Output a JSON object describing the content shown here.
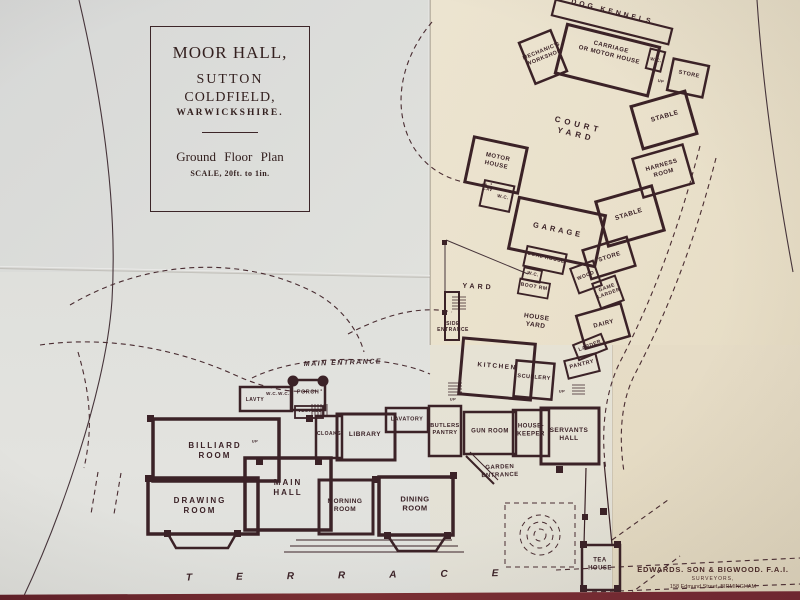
{
  "colors": {
    "ink": "#3b2227",
    "paper_cool": "#dddedb",
    "paper_warm": "#e9e0ca",
    "paper_warm_dark": "#e3d9c1",
    "table_red": "#6e2731"
  },
  "title_block": {
    "title": "MOOR HALL,",
    "line2": "SUTTON",
    "line3": "COLDFIELD,",
    "line4": "WARWICKSHIRE.",
    "plan_title": "Ground Floor Plan",
    "scale": "SCALE, 20ft. to 1in."
  },
  "terrace": {
    "label": "TERRACE"
  },
  "surveyor": {
    "name": "EDWARDS. SON & BIGWOOD. F.A.I.",
    "role": "SURVEYORS,",
    "address": "158 Edmund Street, BIRMINGHAM"
  },
  "rooms": [
    {
      "id": "dog-kennels",
      "label": "DOG KENNELS",
      "x": 612,
      "y": 13,
      "rot": 14,
      "fs": 7,
      "ls": 3
    },
    {
      "id": "mechanics-workshop",
      "label": "MECHANIC'S\nWORKSHOP",
      "x": 543,
      "y": 55,
      "rot": -22,
      "fs": 5.5
    },
    {
      "id": "carriage-house",
      "label": "CARRIAGE\nOR MOTOR HOUSE",
      "x": 610,
      "y": 52,
      "rot": 14,
      "fs": 6
    },
    {
      "id": "wc-top",
      "label": "W.C.",
      "x": 656,
      "y": 60,
      "rot": 12,
      "fs": 4.5
    },
    {
      "id": "store-top",
      "label": "STORE",
      "x": 689,
      "y": 75,
      "rot": 12,
      "fs": 5.5
    },
    {
      "id": "up-top",
      "label": "UP",
      "x": 661,
      "y": 81,
      "rot": 12,
      "fs": 4
    },
    {
      "id": "stable-1",
      "label": "STABLE",
      "x": 665,
      "y": 117,
      "rot": -16,
      "fs": 6.5
    },
    {
      "id": "harness-room",
      "label": "HARNESS\nROOM",
      "x": 663,
      "y": 170,
      "rot": -16,
      "fs": 6
    },
    {
      "id": "stable-2",
      "label": "STABLE",
      "x": 629,
      "y": 215,
      "rot": -18,
      "fs": 6.5
    },
    {
      "id": "store-2",
      "label": "STORE",
      "x": 610,
      "y": 258,
      "rot": -18,
      "fs": 6
    },
    {
      "id": "wood",
      "label": "WOOD",
      "x": 586,
      "y": 276,
      "rot": -22,
      "fs": 5
    },
    {
      "id": "game-larder",
      "label": "GAME\nLARDER",
      "x": 608,
      "y": 291,
      "rot": -20,
      "fs": 5
    },
    {
      "id": "dairy",
      "label": "DAIRY",
      "x": 604,
      "y": 325,
      "rot": -14,
      "fs": 6
    },
    {
      "id": "larder",
      "label": "LARDER",
      "x": 590,
      "y": 346,
      "rot": -22,
      "fs": 5
    },
    {
      "id": "pantry",
      "label": "PANTRY",
      "x": 582,
      "y": 365,
      "rot": -14,
      "fs": 5.5
    },
    {
      "id": "court-yard",
      "label": "COURT\nYARD",
      "x": 577,
      "y": 130,
      "rot": 14,
      "fs": 8,
      "ls": 4
    },
    {
      "id": "motor-house",
      "label": "MOTOR\nHOUSE",
      "x": 497,
      "y": 162,
      "rot": 12,
      "fs": 6
    },
    {
      "id": "lav-small",
      "label": "LAV",
      "x": 488,
      "y": 189,
      "rot": 12,
      "fs": 4
    },
    {
      "id": "wc-motor",
      "label": "W.C.",
      "x": 503,
      "y": 197,
      "rot": 12,
      "fs": 4.5
    },
    {
      "id": "garage",
      "label": "GARAGE",
      "x": 558,
      "y": 230,
      "rot": 12,
      "fs": 7.5,
      "ls": 3
    },
    {
      "id": "coal-house",
      "label": "COAL HOUSE",
      "x": 546,
      "y": 258,
      "rot": 13,
      "fs": 5
    },
    {
      "id": "wc-yard",
      "label": "W.C.",
      "x": 533,
      "y": 274,
      "rot": 13,
      "fs": 4.5
    },
    {
      "id": "boot-room",
      "label": "BOOT RM",
      "x": 534,
      "y": 287,
      "rot": 10,
      "fs": 5
    },
    {
      "id": "yard",
      "label": "YARD",
      "x": 478,
      "y": 288,
      "rot": 3,
      "fs": 7,
      "ls": 3
    },
    {
      "id": "house-yard",
      "label": "HOUSE\nYARD",
      "x": 536,
      "y": 322,
      "rot": 8,
      "fs": 6.5
    },
    {
      "id": "side-entrance",
      "label": "SIDE\nENTRANCE",
      "x": 453,
      "y": 327,
      "rot": 0,
      "fs": 5
    },
    {
      "id": "kitchen",
      "label": "KITCHEN",
      "x": 497,
      "y": 367,
      "rot": 5,
      "fs": 6.5,
      "ls": 1.5
    },
    {
      "id": "scullery",
      "label": "SCULLERY",
      "x": 534,
      "y": 378,
      "rot": 5,
      "fs": 5.5
    },
    {
      "id": "main-entrance",
      "label": "MAIN ENTRANCE",
      "x": 343,
      "y": 364,
      "rot": -2,
      "fs": 7,
      "ls": 1.5,
      "italic": true
    },
    {
      "id": "lavty",
      "label": "LAVTY",
      "x": 255,
      "y": 400,
      "rot": 0,
      "fs": 5
    },
    {
      "id": "wc-ent-1",
      "label": "W.C.",
      "x": 272,
      "y": 394,
      "rot": 0,
      "fs": 4.5
    },
    {
      "id": "wc-ent-2",
      "label": "W.C.",
      "x": 284,
      "y": 394,
      "rot": 0,
      "fs": 4.5
    },
    {
      "id": "porch",
      "label": "PORCH",
      "x": 308,
      "y": 393,
      "rot": 0,
      "fs": 5.5
    },
    {
      "id": "vestibule",
      "label": "VESTBLE",
      "x": 310,
      "y": 411,
      "rot": 0,
      "fs": 4.5
    },
    {
      "id": "cloaks",
      "label": "CLOAKS",
      "x": 329,
      "y": 434,
      "rot": 0,
      "fs": 5
    },
    {
      "id": "library",
      "label": "LIBRARY",
      "x": 365,
      "y": 435,
      "rot": 0,
      "fs": 6.5
    },
    {
      "id": "lavatory",
      "label": "LAVATORY",
      "x": 407,
      "y": 420,
      "rot": 0,
      "fs": 5.5
    },
    {
      "id": "butlers-pantry",
      "label": "BUTLERS\nPANTRY",
      "x": 445,
      "y": 430,
      "rot": 0,
      "fs": 5.5
    },
    {
      "id": "gun-room",
      "label": "GUN ROOM",
      "x": 490,
      "y": 432,
      "rot": 0,
      "fs": 6
    },
    {
      "id": "housekeeper",
      "label": "HOUSE-\nKEEPER",
      "x": 531,
      "y": 431,
      "rot": 0,
      "fs": 6
    },
    {
      "id": "servants-hall",
      "label": "SERVANTS\nHALL",
      "x": 569,
      "y": 435,
      "rot": 0,
      "fs": 6.5
    },
    {
      "id": "garden-entrance",
      "label": "GARDEN\nENTRANCE",
      "x": 500,
      "y": 472,
      "rot": -2,
      "fs": 6
    },
    {
      "id": "billiard-room",
      "label": "BILLIARD\nROOM",
      "x": 215,
      "y": 451,
      "rot": 0,
      "fs": 8,
      "ls": 2
    },
    {
      "id": "up-stairs-main",
      "label": "UP",
      "x": 255,
      "y": 441,
      "rot": 0,
      "fs": 4
    },
    {
      "id": "main-hall",
      "label": "MAIN\nHALL",
      "x": 288,
      "y": 488,
      "rot": 0,
      "fs": 8,
      "ls": 2
    },
    {
      "id": "drawing-room",
      "label": "DRAWING\nROOM",
      "x": 200,
      "y": 506,
      "rot": 0,
      "fs": 8,
      "ls": 2
    },
    {
      "id": "morning-room",
      "label": "MORNING\nROOM",
      "x": 345,
      "y": 506,
      "rot": 0,
      "fs": 6.5
    },
    {
      "id": "dining-room",
      "label": "DINING\nROOM",
      "x": 415,
      "y": 504,
      "rot": 0,
      "fs": 7.5
    },
    {
      "id": "tea-house",
      "label": "TEA\nHOUSE",
      "x": 600,
      "y": 565,
      "rot": 0,
      "fs": 6
    },
    {
      "id": "up-kitchen",
      "label": "UP",
      "x": 453,
      "y": 399,
      "rot": 0,
      "fs": 4
    },
    {
      "id": "up-servants",
      "label": "UP",
      "x": 562,
      "y": 391,
      "rot": 0,
      "fs": 4
    }
  ]
}
